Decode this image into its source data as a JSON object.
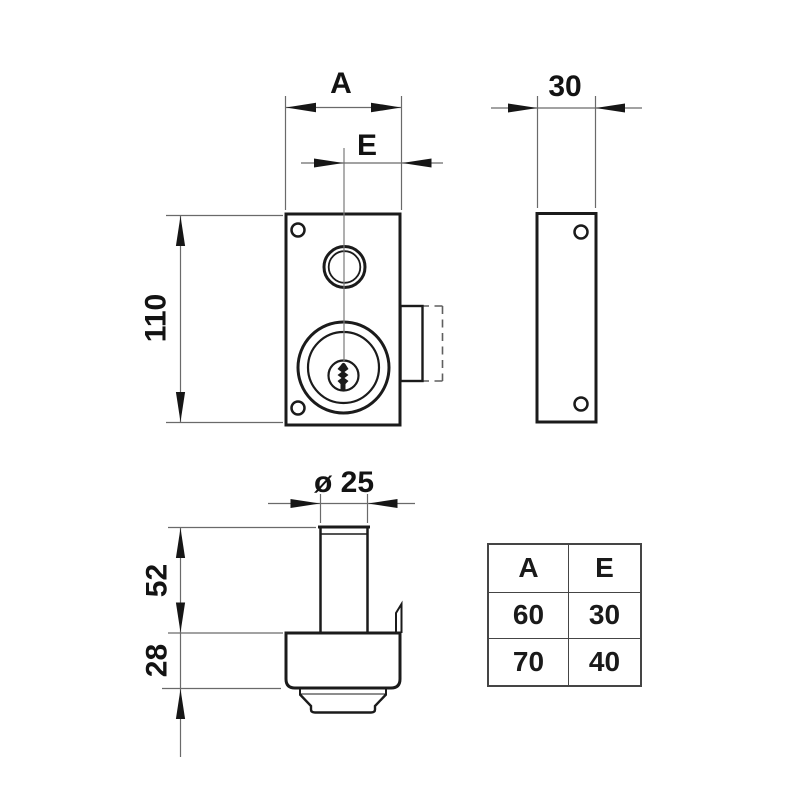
{
  "dimensions": {
    "front_width_label": "A",
    "front_backset_label": "E",
    "front_height_label": "110",
    "side_depth_label": "30",
    "cylinder_diameter_label": "ø 25",
    "cylinder_protrusion_label": "52",
    "case_depth_label": "28"
  },
  "size_table": {
    "headers": [
      "A",
      "E"
    ],
    "rows": [
      [
        "60",
        "30"
      ],
      [
        "70",
        "40"
      ]
    ]
  },
  "colors": {
    "outline": "#1b1b1b",
    "dimension_line": "#6a6a6a",
    "arrow": "#161616",
    "text": "#131313",
    "background": "#ffffff"
  }
}
